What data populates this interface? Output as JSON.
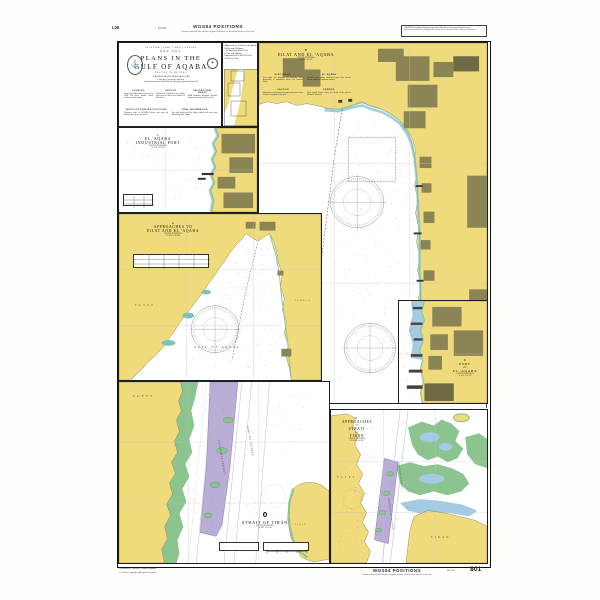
{
  "colors": {
    "land": "#f0db7c",
    "urban": "#8b8556",
    "urban_dark": "#6e6b44",
    "shoal": "#a5cbe4",
    "reef": "#8cc48f",
    "tss": "#b2a4d2",
    "tss_edge": "#8d7cb8",
    "teal": "#7fc0bd",
    "sea": "#ffffff",
    "ink": "#1f1f1f",
    "sounding": "#41546e"
  },
  "margins": {
    "top_left_code": "L08",
    "top_left_small": "INT 801",
    "wgs_title_top": "WGS84 POSITIONS",
    "wgs_sub_top": "Positions obtained from satellite navigation systems can be plotted directly on this chart",
    "note_line1": "CAUTION: Uncharted dangers may exist within the areas covered by this chart.",
    "note_line2": "Mariners are advised to navigate with caution and to consult the latest Notices to Mariners.",
    "bottom_left_line1": "Published at Taunton, United Kingdom",
    "bottom_left_line2": "© Crown Copyright. All rights reserved.",
    "wgs_title_bottom": "WGS84 POSITIONS",
    "wgs_sub_bottom": "Positions obtained from satellite navigation systems can be plotted directly on this chart",
    "bottom_small": "INT 801",
    "chart_number": "801"
  },
  "title_block": {
    "series": "INTERNATIONAL CHART SERIES",
    "region": "RED SEA",
    "title1": "PLANS IN THE",
    "title2": "GULF OF AQABA",
    "depths": "DEPTHS IN METRES",
    "para": "SCALES AS SHOWN UNDER EACH PLAN\nProjection: Transverse Mercator\nNavigational marks: IALA Maritime Buoyage System (Region A)",
    "crest_glyph": "⚓",
    "emblem_glyph": "✦",
    "notes": [
      {
        "heading": "SOURCES",
        "body": "Data from Government surveys to 1998 and from smaller scale charts of earlier dates."
      },
      {
        "heading": "CAUTION",
        "body": "Submarine pipelines and cables may exist in areas not shown on this chart."
      },
      {
        "heading": "NAVIGATIONAL MARKS",
        "body": "IALA Maritime Buoyage System Region A (red to port) is in use."
      },
      {
        "heading": "SATELLITE-DERIVED POSITIONS",
        "body": "Positions refer to WGS84 Datum and may be plotted directly on this chart."
      },
      {
        "heading": "TIDAL INFORMATION",
        "body": "For tidal levels see the tables under each plan and Admiralty Tide Tables."
      }
    ]
  },
  "index_panel": {
    "lines": [
      "A  Approaches to Eilat and El 'Aqaba",
      "B  Eilat and El 'Aqaba",
      "C  El 'Aqaba Industrial Port",
      "D  Port of El 'Aqaba",
      "E  Approaches to Strait of Tirān",
      "F  Strait of Tirān"
    ]
  },
  "panels": {
    "a": {
      "letter": "A",
      "title1": "APPROACHES TO",
      "title2": "EILAT AND EL 'AQABA",
      "sub": "DEPTHS IN METRES\nSCALE 1:100 000",
      "sea_label": "GULF OF AQABA",
      "left_label": "EGYPT",
      "right_label": "JORDAN"
    },
    "b": {
      "letter": "B",
      "title": "EILAT AND EL 'AQABA",
      "sub": "DEPTHS IN METRES\nSCALE 1:12 500",
      "notes": [
        {
          "heading": "ELAT (EILAT)",
          "body": "Port radio and pilotage are available H24. Anchoring is prohibited within the harbour limits."
        },
        {
          "heading": "EL 'AQABA",
          "body": "Vessels must obtain clearance from Port Control before entering Jordanian waters."
        },
        {
          "heading": "CAUTION",
          "body": "Numerous uncharted mooring buoys exist close inshore throughout this plan."
        },
        {
          "heading": "FERRIES",
          "body": "High speed ferries cross the head of the gulf at frequent intervals."
        }
      ]
    },
    "c": {
      "letter": "C",
      "title1": "EL 'AQABA",
      "title2": "INDUSTRIAL PORT",
      "sub": "DEPTHS IN METRES\nSCALE 1:12 500"
    },
    "d": {
      "letter": "D",
      "title1": "PORT",
      "title2": "OF",
      "title3": "EL 'AQABA",
      "sub": "DEPTHS IN METRES\nSCALE 1:12 500"
    },
    "e": {
      "letter": "E.",
      "line1": "APPROACHES",
      "line2": "TO",
      "line3": "STRAIT",
      "line4": "OF",
      "line5": "TIRAN",
      "sub": "DEPTHS IN METRES\nSCALE 1:145 000",
      "left_label": "EGYPT",
      "island_label": "TIRAN",
      "passage1": "ENTERPRISE PASSAGE",
      "passage2": "GRAFTON PASSAGE"
    },
    "f": {
      "letter": "F",
      "title": "STRAIT OF TIRĀN",
      "sub": "DEPTHS IN METRES\nSCALE 1:50 000",
      "left_label": "EGYPT",
      "island_label": "TIRĀN",
      "passage1": "ENTERPRISE PASSAGE",
      "passage2": "GRAFTON PASSAGE"
    }
  }
}
